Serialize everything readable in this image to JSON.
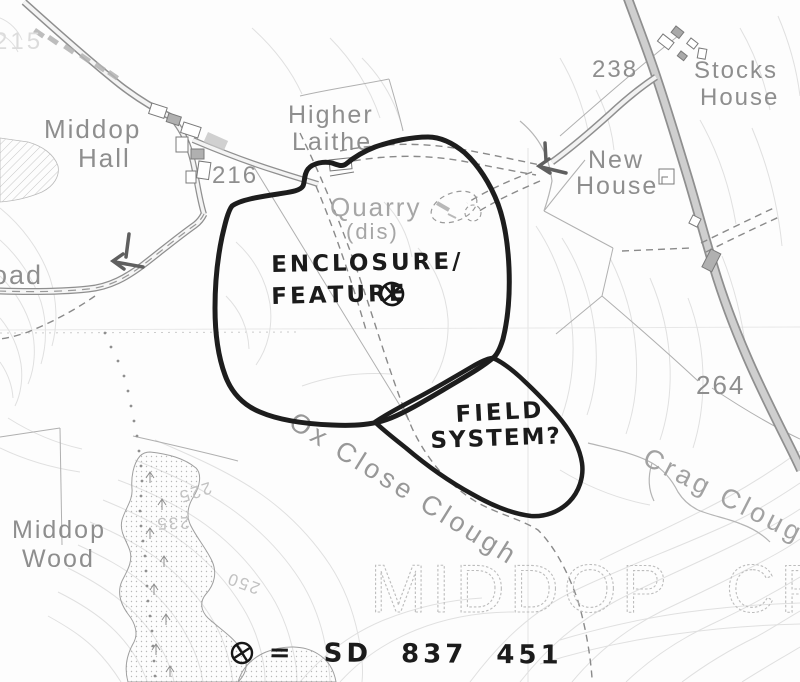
{
  "map_type": "annotated-ordnance-survey-scan",
  "labels": [
    {
      "name": "spot-height-215",
      "text": "215"
    },
    {
      "name": "middop-hall-line1",
      "text": "Middop"
    },
    {
      "name": "middop-hall-line2",
      "text": "Hall"
    },
    {
      "name": "spot-height-216",
      "text": "216"
    },
    {
      "name": "higher-laithe-line1",
      "text": "Higher"
    },
    {
      "name": "higher-laithe-line2",
      "text": "Laithe"
    },
    {
      "name": "quarry-line1",
      "text": "Quarry"
    },
    {
      "name": "quarry-line2",
      "text": "(dis)"
    },
    {
      "name": "spot-height-238",
      "text": "238"
    },
    {
      "name": "stocks-house-line1",
      "text": "Stocks"
    },
    {
      "name": "stocks-house-line2",
      "text": "House"
    },
    {
      "name": "new-house-line1",
      "text": "New"
    },
    {
      "name": "new-house-line2",
      "text": "House"
    },
    {
      "name": "spot-height-264",
      "text": "264"
    },
    {
      "name": "crag-clough",
      "text": "Crag Clough"
    },
    {
      "name": "ox-close-clough",
      "text": "Ox Close Clough"
    },
    {
      "name": "middop-wood-line1",
      "text": "Middop"
    },
    {
      "name": "middop-wood-line2",
      "text": "Wood"
    },
    {
      "name": "road-name-partial",
      "text": "oad"
    },
    {
      "name": "contour-225",
      "text": "225"
    },
    {
      "name": "contour-235",
      "text": "235"
    },
    {
      "name": "contour-250",
      "text": "250"
    }
  ],
  "parish": {
    "word1": "MIDDOP",
    "word2": "CP"
  },
  "annotations": {
    "enclosure_line1": "ENCLOSURE/",
    "enclosure_line2": "FEATURE",
    "field_line1": "FIELD",
    "field_line2": "SYSTEM?",
    "legend_text": "= SD 837 451"
  },
  "symbols": {
    "target_marker": "circled-x",
    "location_arrows": 2
  },
  "colors": {
    "hand_ink": "#1b1b1b",
    "label_gray": "#8e8e8e",
    "faint_gray": "#c2c2c2",
    "contour": "#e0e0e0",
    "road_fill": "#cfcfcf",
    "parish_outline": "#bdbdbd"
  }
}
